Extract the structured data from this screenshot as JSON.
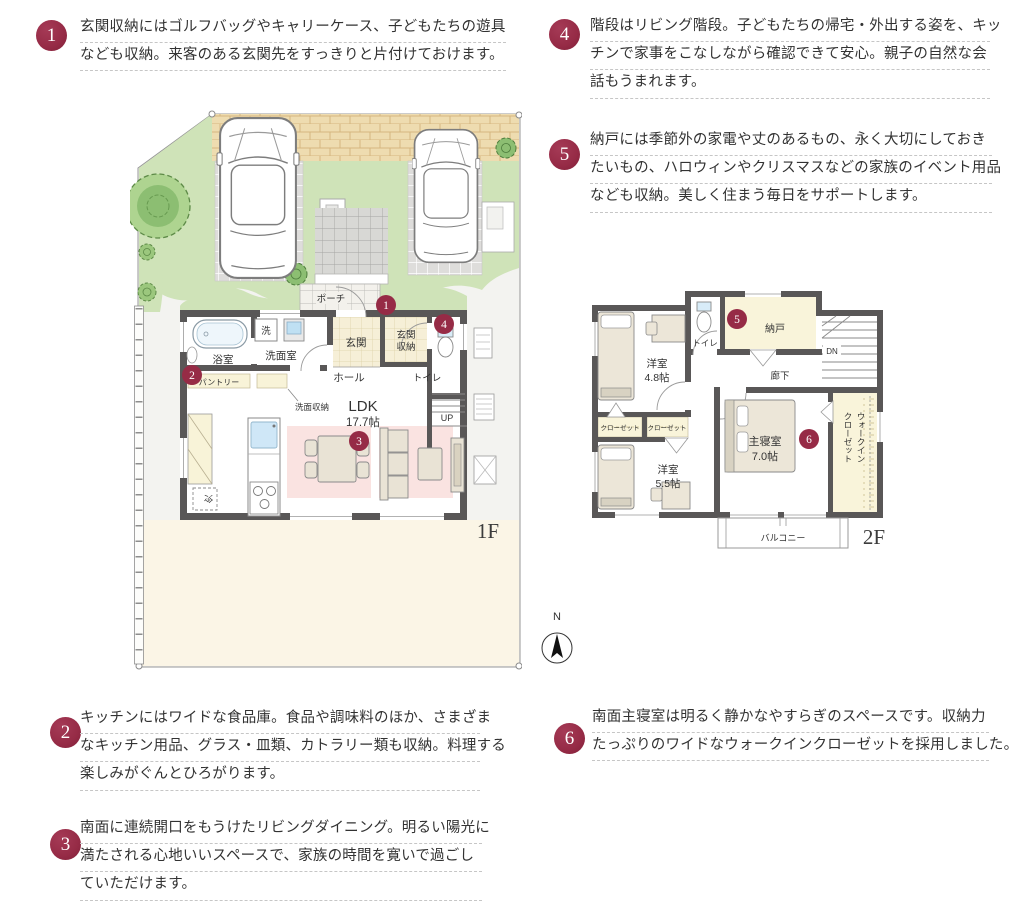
{
  "colors": {
    "badge_accent": "#962b46",
    "wall": "#595757",
    "lawn": "#cfe3b8",
    "brick_paving": "#eedcb0",
    "paver": "#dedddb",
    "ldk_pink": "#fae3e1",
    "storage_cream": "#f8f3d8",
    "yard_cream": "#fbf5e6"
  },
  "notes": {
    "n1": {
      "num": "1",
      "lines": [
        "玄関収納にはゴルフバッグやキャリーケース、子どもたちの遊具",
        "なども収納。来客のある玄関先をすっきりと片付けておけます。"
      ]
    },
    "n2": {
      "num": "2",
      "lines": [
        "キッチンにはワイドな食品庫。食品や調味料のほか、さまざま",
        "なキッチン用品、グラス・皿類、カトラリー類も収納。料理する",
        "楽しみがぐんとひろがります。"
      ]
    },
    "n3": {
      "num": "3",
      "lines": [
        "南面に連続開口をもうけたリビングダイニング。明るい陽光に",
        "満たされる心地いいスペースで、家族の時間を寛いで過ごし",
        "ていただけます。"
      ]
    },
    "n4": {
      "num": "4",
      "lines": [
        "階段はリビング階段。子どもたちの帰宅・外出する姿を、キッ",
        "チンで家事をこなしながら確認できて安心。親子の自然な会",
        "話もうまれます。"
      ]
    },
    "n5": {
      "num": "5",
      "lines": [
        "納戸には季節外の家電や丈のあるもの、永く大切にしておき",
        "たいもの、ハロウィンやクリスマスなどの家族のイベント用品",
        "なども収納。美しく住まう毎日をサポートします。"
      ]
    },
    "n6": {
      "num": "6",
      "lines": [
        "南面主寝室は明るく静かなやすらぎのスペースです。収納力",
        "たっぷりのワイドなウォークインクローゼットを採用しました。"
      ]
    }
  },
  "floor1": {
    "label": "1F",
    "porch": "ポーチ",
    "bath": "浴室",
    "washer": "洗",
    "washroom": "洗面室",
    "entrance": "玄関",
    "entrance_storage_1": "玄関",
    "entrance_storage_2": "収納",
    "hall": "ホール",
    "toilet": "トイレ",
    "pantry": "パントリー",
    "washroom_storage": "洗面収納",
    "ldk": "LDK",
    "ldk_size": "17.7帖",
    "fridge": "冷",
    "up": "UP"
  },
  "floor2": {
    "label": "2F",
    "room48_1": "洋室",
    "room48_2": "4.8帖",
    "toilet": "トイレ",
    "storage": "納戸",
    "dn": "DN",
    "corridor": "廊下",
    "closet_a": "クローゼット",
    "closet_b": "クローゼット",
    "room55_1": "洋室",
    "room55_2": "5.5帖",
    "master_1": "主寝室",
    "master_2": "7.0帖",
    "wic_1": "ウォークイン",
    "wic_2": "クローゼット",
    "balcony": "バルコニー"
  },
  "compass": {
    "north": "N"
  }
}
